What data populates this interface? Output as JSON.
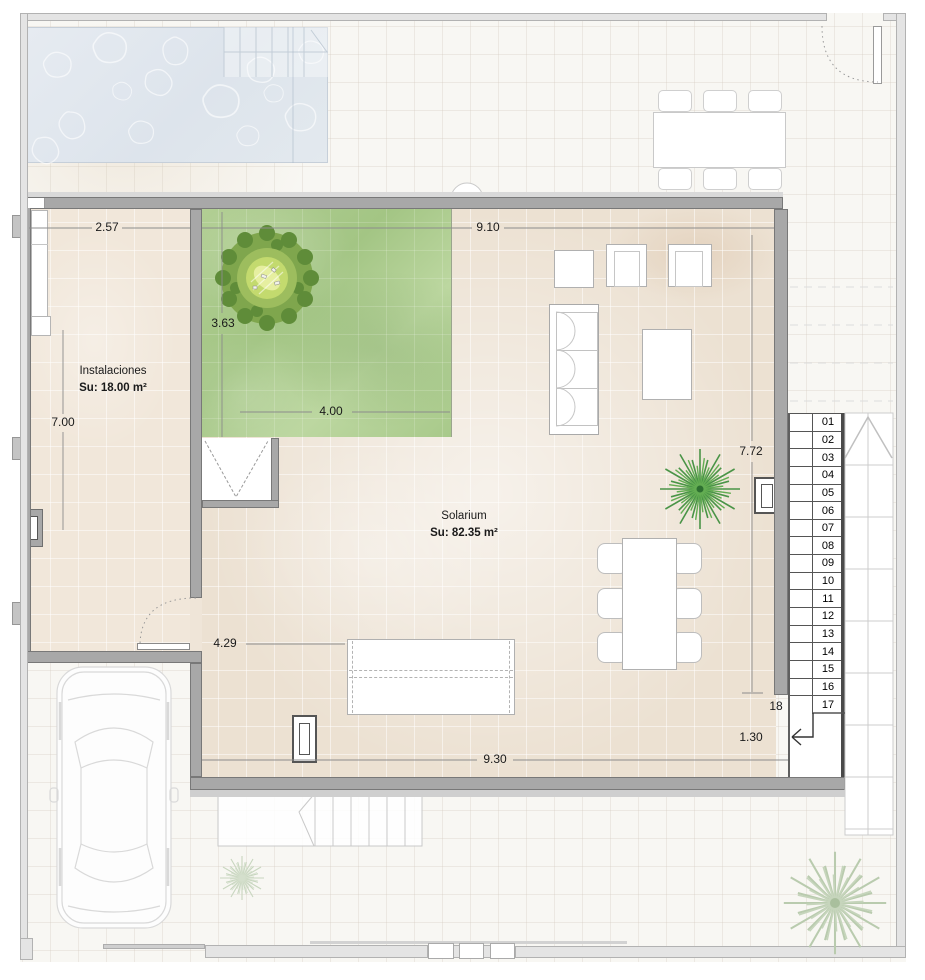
{
  "plan": {
    "rooms": [
      {
        "name": "Instalaciones",
        "area": "Su: 18.00 m²"
      },
      {
        "name": "Solarium",
        "area": "Su: 82.35 m²"
      }
    ],
    "dimensions": {
      "instalaciones_width": "2.57",
      "solarium_width": "9.10",
      "green_height": "3.63",
      "green_width": "4.00",
      "instalaciones_height": "7.00",
      "solarium_height": "7.72",
      "entry_width": "4.29",
      "solarium_bottom_width": "9.30",
      "stair_landing_width": "1.30",
      "stair_step_label": "18"
    },
    "stairs": {
      "steps": [
        "01",
        "02",
        "03",
        "04",
        "05",
        "06",
        "07",
        "08",
        "09",
        "10",
        "11",
        "12",
        "13",
        "14",
        "15",
        "16",
        "17"
      ]
    },
    "icons": [
      "pool",
      "pool-steps",
      "lawn",
      "tree",
      "palm-tree",
      "car",
      "sofa",
      "coffee-table",
      "dining-table",
      "chair",
      "sun-lounger",
      "vent",
      "stairs",
      "down-arrow",
      "door-swing",
      "gate-leaf",
      "pergola-grid",
      "outdoor-dining-set",
      "planter-pot"
    ],
    "colors": {
      "wall": "#a8a8a8",
      "boundary_wall": "#e4e4e4",
      "solarium_floor": "#ece1d2",
      "instalaciones_floor": "#f1e7da",
      "lawn_green": "#aecd92",
      "pool_water": "#dfe6ed",
      "tree_green": "#7fa64d",
      "palm_green": "#4a9447"
    }
  }
}
